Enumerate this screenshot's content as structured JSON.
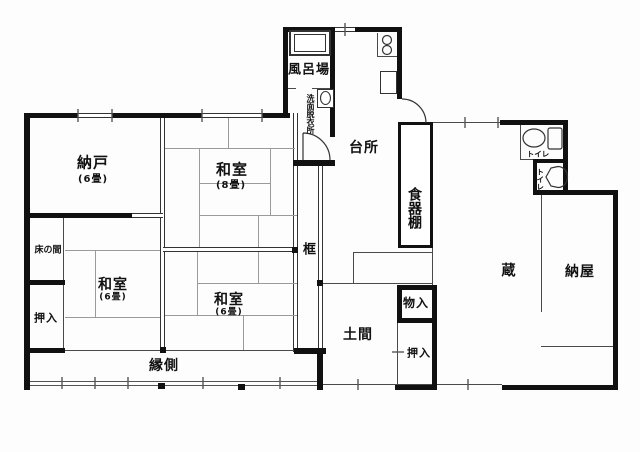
{
  "colors": {
    "wall": "#111111",
    "line": "#4a4a4a",
    "tatami_line": "#9a9a9a",
    "background": "#ffffff"
  },
  "rooms": {
    "nando": {
      "name": "納戸",
      "size": "(6畳)"
    },
    "washitsu8": {
      "name": "和室",
      "size": "(8畳)"
    },
    "washitsu6a": {
      "name": "和室",
      "size": "(6畳)"
    },
    "washitsu6b": {
      "name": "和室",
      "size": "(6畳)"
    },
    "furoba": {
      "name": "風呂場"
    },
    "senmen": {
      "name": "洗面脱衣所"
    },
    "daidokoro": {
      "name": "台所"
    },
    "shokkidana": {
      "name": "食器棚"
    },
    "toire1": {
      "name": "トイレ"
    },
    "toire2": {
      "name": "トイレ"
    },
    "tokonoma": {
      "name": "床の間"
    },
    "oshiire1": {
      "name": "押入"
    },
    "monoire": {
      "name": "物入"
    },
    "oshiire2": {
      "name": "押入"
    },
    "doma": {
      "name": "土間"
    },
    "kamachi": {
      "name": "框"
    },
    "kura": {
      "name": "蔵"
    },
    "naya": {
      "name": "納屋"
    },
    "engawa": {
      "name": "縁側"
    }
  },
  "fixtures": [
    "bathtub-icon",
    "stove-icon",
    "kitchen-sink-icon",
    "washbasin-icon",
    "toilet-icon",
    "urinal-icon",
    "door-swing-icon"
  ]
}
